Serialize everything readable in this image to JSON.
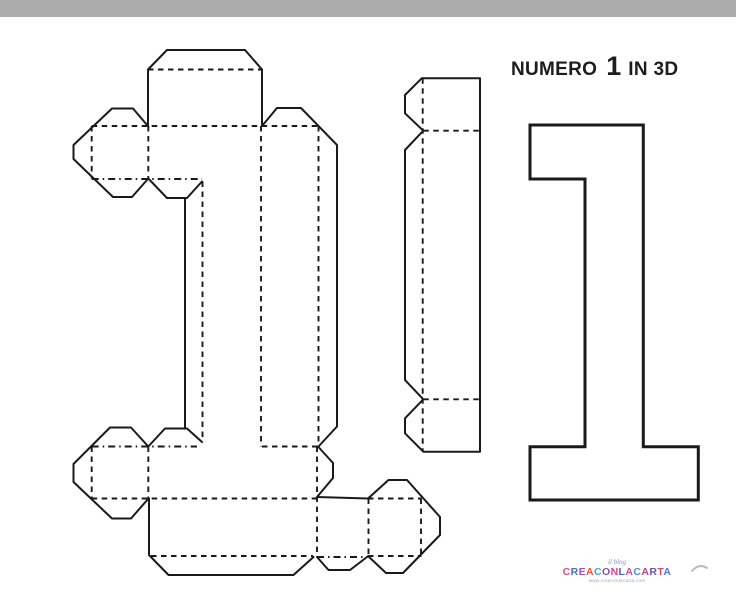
{
  "page": {
    "background": "#ffffff",
    "top_bar_color": "#ababab",
    "line_color": "#1a1a1a"
  },
  "title": {
    "prefix": "NUMERO",
    "number": "1",
    "suffix": "IN 3D"
  },
  "watermark": {
    "script": "il blog",
    "main": "CREACONLACARTA",
    "tagline": "www.creaconlacarta.com",
    "letter_colors": [
      "#e04a8f",
      "#4a6fc0",
      "#a94fb0",
      "#e0563c",
      "#4aa0d8",
      "#8a4fa8",
      "#d8438a",
      "#5060b8",
      "#c05098",
      "#4a8fd0",
      "#b0487c",
      "#6a58b0",
      "#d04f70",
      "#4f7ac8"
    ]
  }
}
